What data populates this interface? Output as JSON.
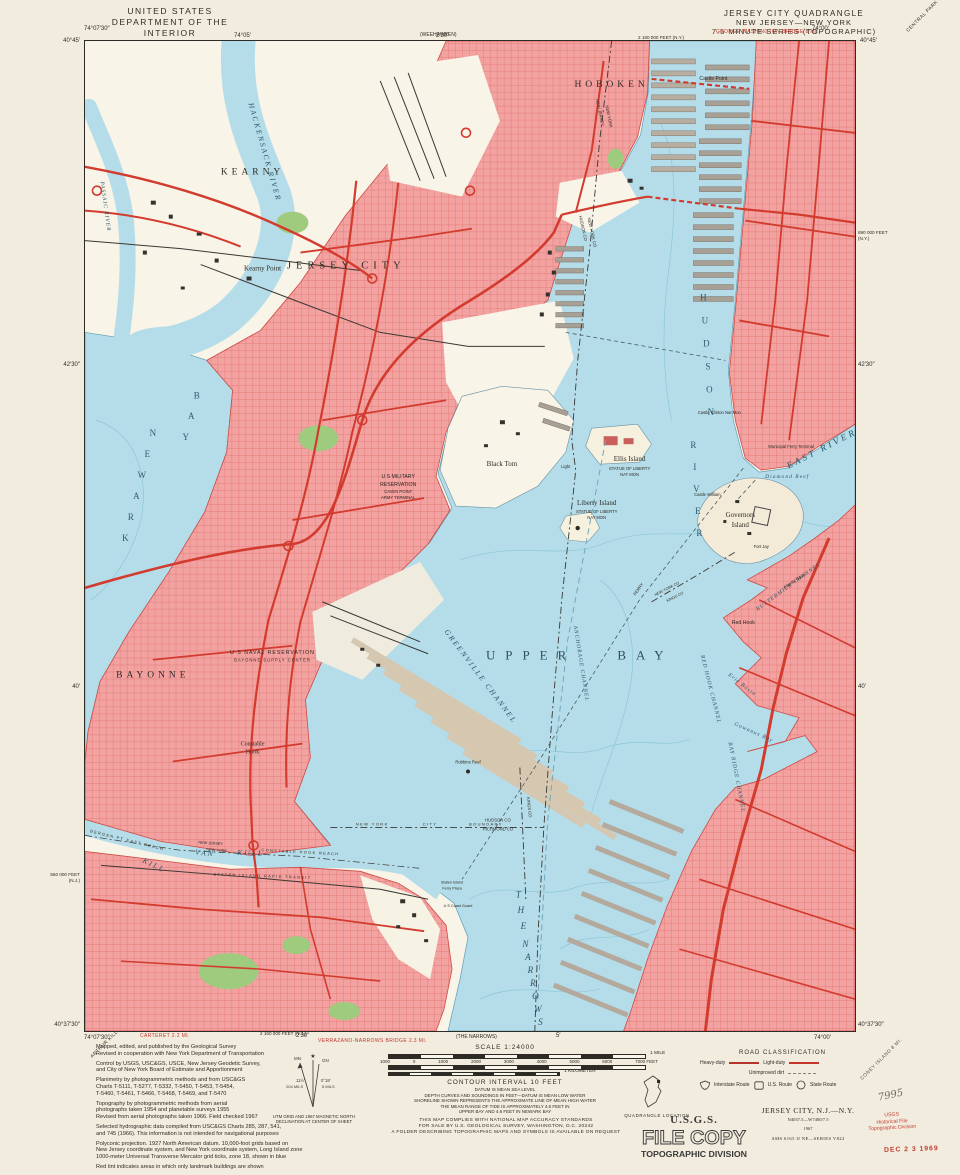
{
  "header": {
    "agency_line1": "UNITED STATES",
    "agency_line2": "DEPARTMENT OF THE INTERIOR",
    "agency_line3": "GEOLOGICAL SURVEY",
    "quad_line1": "JERSEY CITY QUADRANGLE",
    "quad_line2": "NEW JERSEY—NEW YORK",
    "quad_line3": "7.5 MINUTE SERIES (TOPOGRAPHIC)",
    "corner_note_ne": "CENTRAL PARK",
    "adjoining_top": "(WEEHAWKEN)",
    "red_note_gwb": "GEORGE WASHINGTON BRIDGE 8 MI."
  },
  "edges": {
    "tl_lon": "74°07′30″",
    "tl_lat": "40°45′",
    "tr_lon": "74°00′",
    "tr_lat": "40°45′",
    "bl_lat": "40°37′30″",
    "bl_lon": "74°07′30″",
    "br_lat": "40°37′30″",
    "br_lon": "74°00′",
    "top_tick1": "74°05′",
    "top_tick2": "2′30″",
    "bottom_tick1": "2′30″",
    "bottom_tick2": "5′",
    "left_tick1": "42′30″",
    "left_tick2": "40′",
    "right_tick1": "42′30″",
    "right_tick2": "40′",
    "grid_top": "2 180 000 FEET (N.Y.)",
    "grid_bottom": "2 160 000 FEET (N.J.)",
    "grid_left": "560 000 FEET\n(N.J.)",
    "grid_right": "690 000 FEET\n(N.Y.)",
    "red_note_carteret": "CARTERET 2.2 MI.",
    "red_note_verrazano": "VERRAZANO-NARROWS BRIDGE 2.3 MI.",
    "adjoining_bottom": "(THE NARROWS)",
    "corner_note_sw": "ARTHUR KILL",
    "corner_note_se": "CONEY ISLAND 8 MI."
  },
  "map": {
    "labels": {
      "kearny": "KEARNY",
      "kearny_point": "Kearny Point",
      "hackensack_river": "HACKENSACK RIVER",
      "passaic_river": "PASSAIC RIVER",
      "newark": "NEWARK",
      "newark_bay_word": "BAY",
      "jersey_city": "JERSEY CITY",
      "hoboken": "HOBOKEN",
      "castle_point": "Castle Point",
      "hudson": "HUDSON",
      "river_word": "RIVER",
      "east_river": "EAST RIVER",
      "nj1": "NEW JERSEY",
      "ny1": "NEW YORK",
      "hudson_co": "HUDSON CO",
      "new_york_co": "NEW YORK CO",
      "military1": "U S MILITARY",
      "military2": "RESERVATION",
      "military3": "CAVEN POINT",
      "military4": "ARMY TERMINAL",
      "black_tom": "Black Tom",
      "ellis_island": "Ellis Island",
      "statue": "STATUE OF LIBERTY",
      "natmon": "NAT MON",
      "liberty_island": "Liberty Island",
      "governors1": "Governors",
      "governors2": "Island",
      "fort_jay": "Fort Jay",
      "castle_william": "Castle William",
      "castle_clinton": "Castle Clinton Nat Mon",
      "ferry_terminal": "Municipal Ferry Terminal",
      "diamond_reef": "Diamond Reef",
      "light": "Light",
      "upper_bay": "UPPER BAY",
      "greenville_channel": "GREENVILLE CHANNEL",
      "anchorage_channel": "ANCHORAGE CHANNEL",
      "ferry": "FERRY",
      "bayonne": "BAYONNE",
      "naval1": "U S NAVAL RESERVATION",
      "naval2": "BAYONNE SUPPLY CENTER",
      "constable1": "Constable",
      "constable2": "Hook",
      "robbins_reef": "Robbins Reef",
      "kill": "KILL",
      "van": "VAN",
      "kull": "KULL",
      "reach": "CONSTABLE HOOK REACH",
      "bergen_reach": "BERGEN PT EAST REACH",
      "sirt": "STATEN ISLAND RAPID TRANSIT",
      "nj2": "NEW JERSEY",
      "ny2": "NEW YORK",
      "the_word": "THE",
      "narrows_word": "NARROWS",
      "bay_ridge_channel": "BAY RIDGE CHANNEL",
      "red_hook_channel": "RED HOOK CHANNEL",
      "buttermilk": "BUTTERMILK CHANNEL",
      "atlantic_basin": "Atlantic Basin",
      "red_hook": "Red Hook",
      "erie_basin": "Erie Basin",
      "gowanus_bay": "Gowanus Bay",
      "new_york_co2": "NEW YORK CO",
      "kings_co2": "KINGS CO",
      "nyc_b1": "NEW YORK",
      "nyc_b2": "CITY",
      "nyc_b3": "BOUNDARY",
      "hudson_co2": "HUDSON CO",
      "richmond_co": "RICHMOND CO",
      "kings_co": "KINGS CO",
      "si_ferry1": "Staten Island",
      "si_ferry2": "Ferry Plaza",
      "coast_guard": "U S Coast Guard"
    },
    "colors": {
      "water": "#b5dde9",
      "urban_tint": "#f2a2a0",
      "road_red": "#d23b2e",
      "park_green": "#9ecb7e"
    }
  },
  "footer": {
    "credits": {
      "p1": "Mapped, edited, and published by the Geological Survey\nRevised in cooperation with New York Department of Transportation",
      "p2": "Control by USGS, USC&GS, USCE, New Jersey Geodetic Survey,\nand City of New York Board of Estimate and Apportionment",
      "p3": "Planimetry by photogrammetric methods and from USC&GS\nCharts T-5111, T-5277, T-5332, T-5450, T-5453, T-5454,\nT-5460, T-5461, T-5466, T-5468, T-5469, and T-5470",
      "p4": "Topography by photogrammetric methods from aerial\nphotographs taken 1954 and planetable surveys 1955\nRevised from aerial photographs taken 1966.  Field checked 1967",
      "p5": "Selected hydrographic data compiled from USC&GS Charts 285, 287, 541,\nand 745 (1966).  This information is not intended for navigational purposes",
      "p6": "Polyconic projection.  1927 North American datum. 10,000-foot grids based on\nNew Jersey coordinate system, and New York coordinate system, Long Island zone\n1000-meter Universal Transverse Mercator grid ticks, zone 18, shown in blue",
      "p7": "Red tint indicates areas in which only landmark buildings are shown"
    },
    "declination": {
      "gn": "GN",
      "mn": "MN",
      "mn_angle": "11½°",
      "mn_mils": "204 MILS",
      "gn_angle": "0°18′",
      "gn_mils": "5 MILS",
      "caption": "UTM GRID AND 1967 MAGNETIC NORTH\nDECLINATION AT CENTER OF SHEET"
    },
    "scale": {
      "label": "SCALE 1:24000",
      "mile": "1 MILE",
      "km": "1 KILOMETER",
      "feet_ticks": [
        "1000",
        "0",
        "1000",
        "2000",
        "3000",
        "4000",
        "5000",
        "6000",
        "7000 FEET"
      ]
    },
    "contour": {
      "line1": "CONTOUR INTERVAL 10 FEET",
      "rest": "DATUM IS MEAN SEA LEVEL\nDEPTH CURVES AND SOUNDINGS IN FEET—DATUM IS MEAN LOW WATER\nSHORELINE SHOWN REPRESENTS THE APPROXIMATE LINE OF MEAN HIGH WATER\nTHE MEAN RANGE OF TIDE IS APPROXIMATELY 4.6 FEET IN\nUPPER BAY AND 4.6 FEET IN NEWARK BAY"
    },
    "accuracy": "THIS MAP COMPLIES WITH NATIONAL MAP ACCURACY STANDARDS\nFOR SALE BY U.S. GEOLOGICAL SURVEY, WASHINGTON, D.C. 20242\nA FOLDER DESCRIBING TOPOGRAPHIC MAPS AND SYMBOLS IS AVAILABLE ON REQUEST",
    "road_class": {
      "title": "ROAD CLASSIFICATION",
      "heavy": "Heavy-duty",
      "light": "Light-duty",
      "unimproved": "Unimproved dirt",
      "interstate": "Interstate Route",
      "us": "U.S. Route",
      "state": "State Route"
    },
    "quad_location": "QUADRANGLE LOCATION",
    "id_block": {
      "title": "JERSEY CITY, N.J.—N.Y.",
      "code": "N4037.5—W7400/7.5",
      "year": "1967",
      "ams": "AMS 6165 II NE—SERIES V822"
    },
    "stamps": {
      "usgs": "U.S.G.S.",
      "file_copy": "FILE COPY",
      "topo": "TOPOGRAPHIC DIVISION",
      "hist": "USGS\nHistorical File\nTopographic Division",
      "date": "DEC 2 3 1969",
      "pencil": "7995"
    }
  }
}
